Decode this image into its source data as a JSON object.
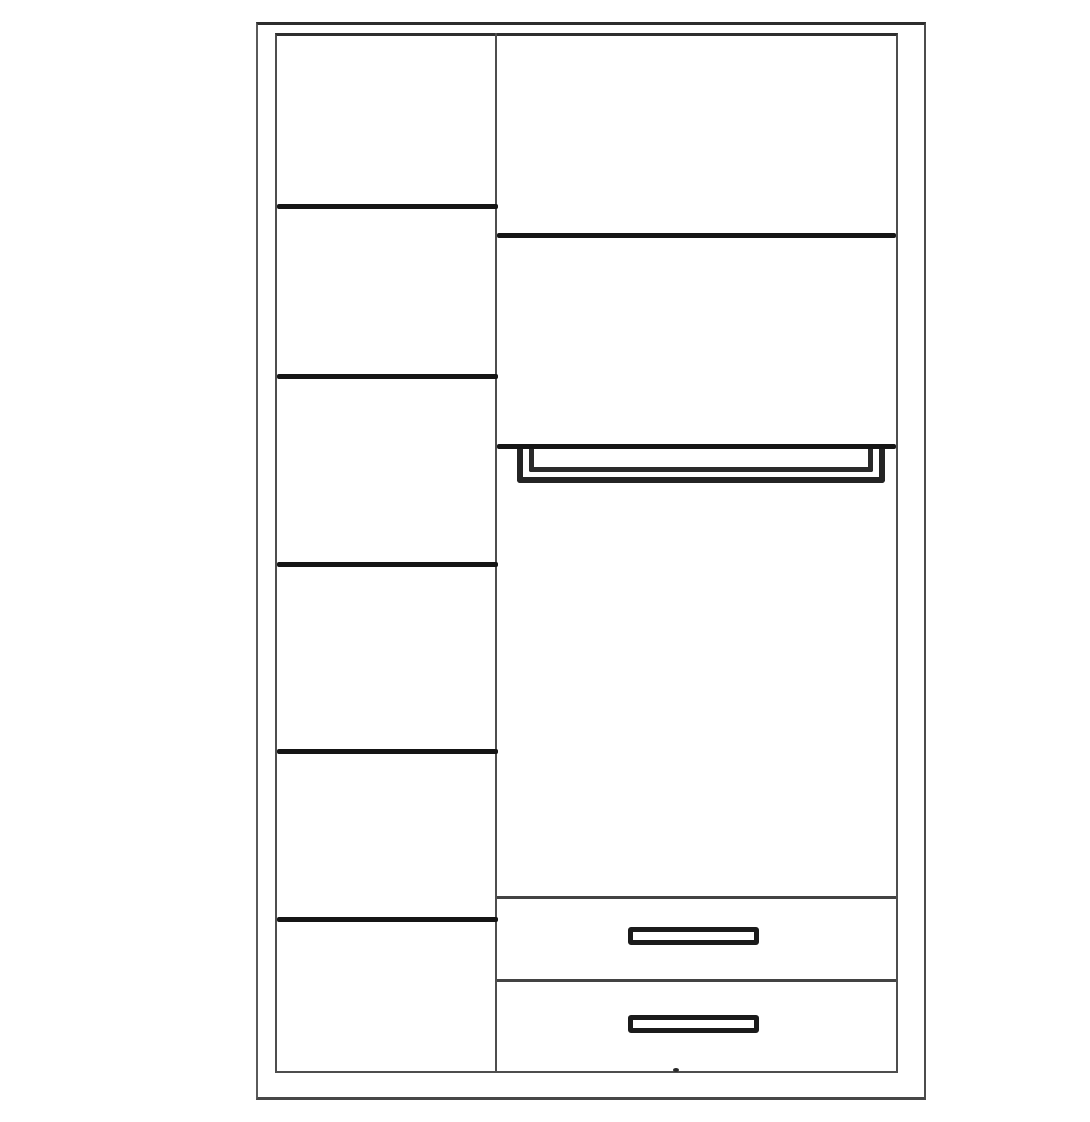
{
  "figure": {
    "kind": "wardrobe interior front-view line drawing",
    "aria_label": "Line drawing of a wardrobe interior: a left column of six shelf compartments, a right section with two upper shelves, a hanging rail, a tall open hanging space, and two drawers with handles at the bottom",
    "colors": {
      "background": "#ffffff",
      "outer_frame_line": "#2d2d2d",
      "carcass_line": "#4e4e4e",
      "shelf_line": "#151515",
      "drawer_line": "#434343",
      "rail_line": "#242424",
      "handle_line": "#1b1b1b"
    },
    "left_column": {
      "name": "shelf column",
      "shelf_count": 5,
      "compartment_count": 6
    },
    "right_column": {
      "name": "hanging and drawer section",
      "upper_shelf_count": 2,
      "hanging_rail_count": 1,
      "drawer_count": 2,
      "drawer_handle_count": 2
    }
  }
}
